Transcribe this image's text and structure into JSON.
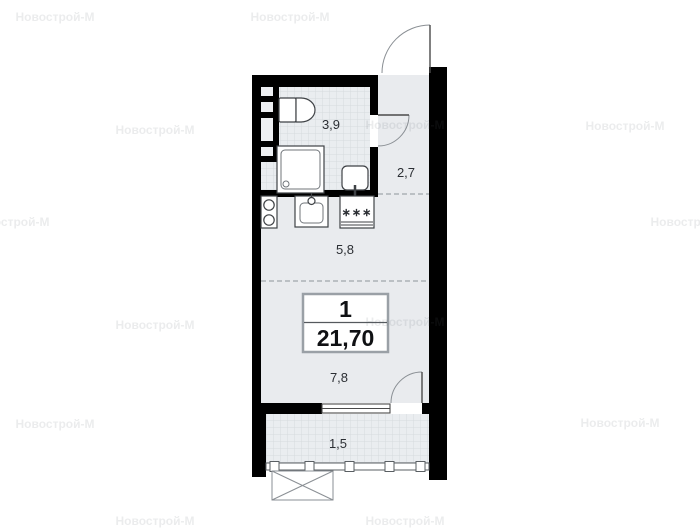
{
  "watermark": {
    "text": "Новострой-М"
  },
  "plan": {
    "unit": {
      "number": "1",
      "area": "21,70"
    },
    "rooms": {
      "bathroom": {
        "area": "3,9"
      },
      "hallway": {
        "area": "2,7"
      },
      "kitchen": {
        "area": "5,8"
      },
      "living": {
        "area": "7,8"
      },
      "balcony": {
        "area": "1,5"
      }
    },
    "symbols": {
      "fridge": "∗∗∗"
    }
  },
  "colors": {
    "wall": "#000000",
    "floor": "#e9ebee",
    "tile_line": "#d6dade",
    "fixture_stroke": "#3f4246",
    "dashed_line": "#a0a6ac",
    "door_arc": "#8a8f94",
    "info_box_border": "#9aa0a6",
    "label_text": "#2b2e33",
    "watermark_text": "#ededed",
    "background": "#ffffff"
  }
}
